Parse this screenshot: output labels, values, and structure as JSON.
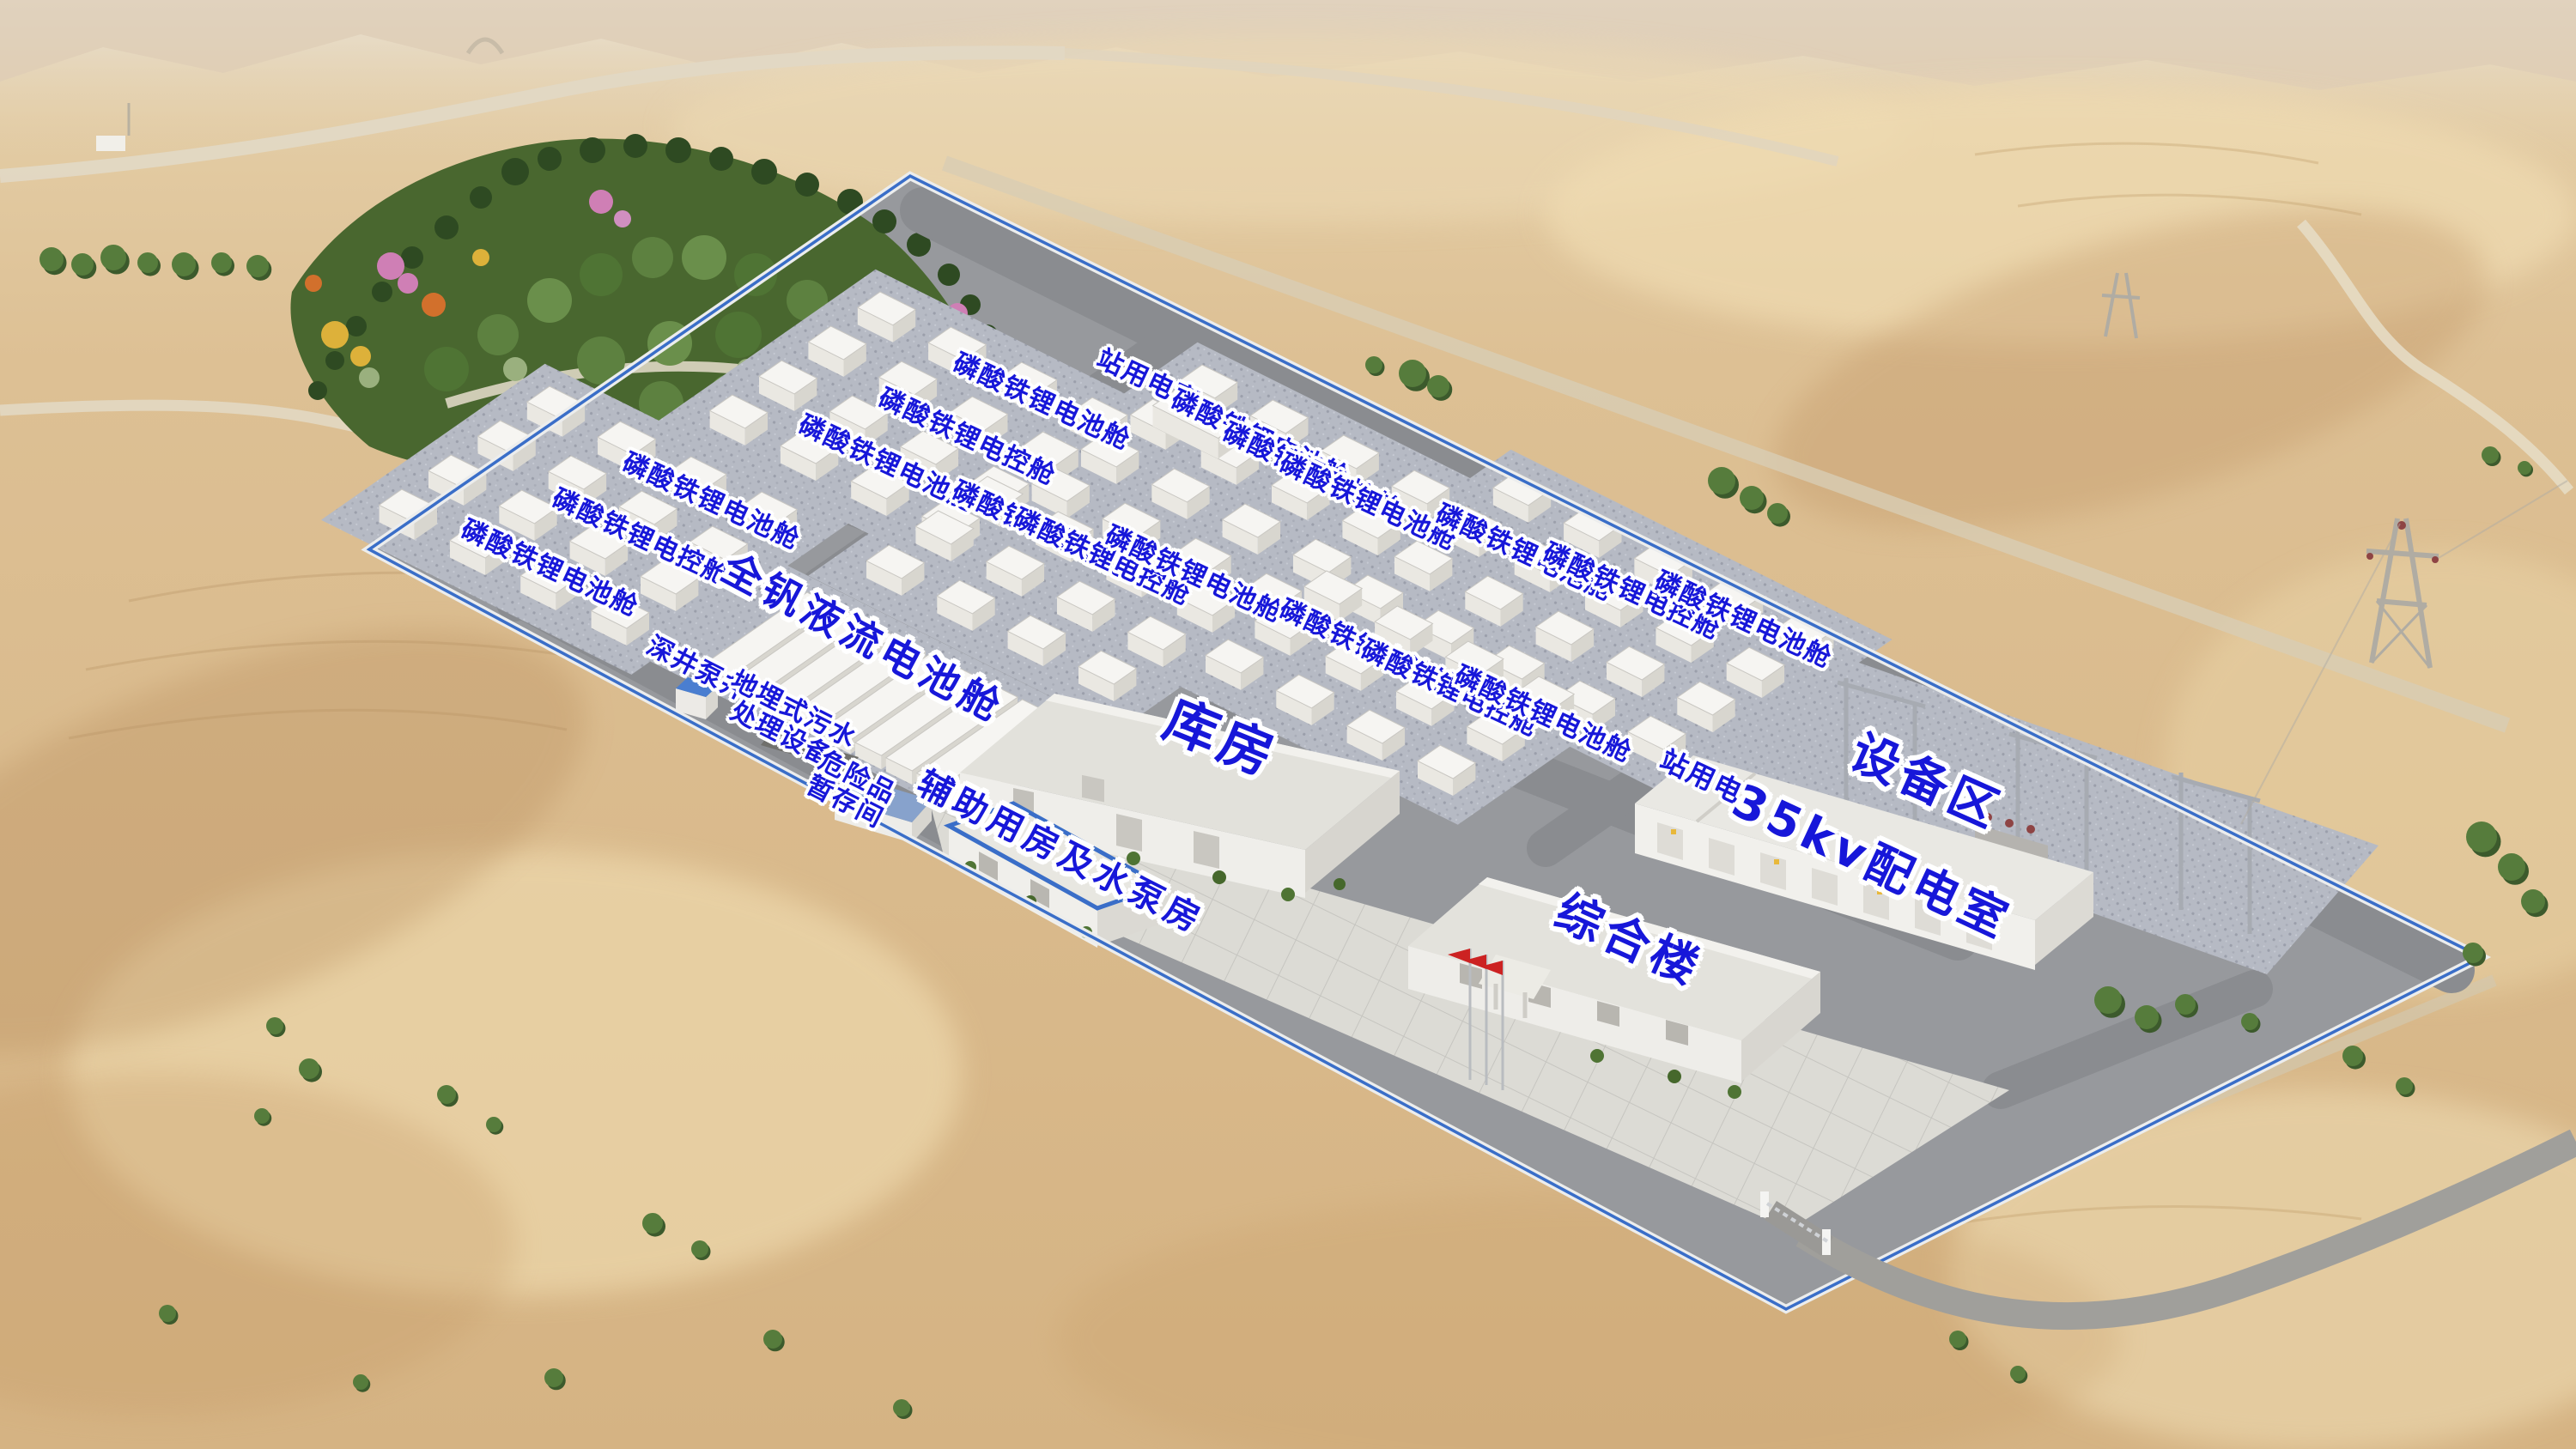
{
  "labels": {
    "battery_cabin": "磷酸铁锂电池舱",
    "control_cabin": "磷酸铁锂电控舱",
    "station_power_room": "站用电室",
    "vanadium_flow_battery_cabin": "全钒液流电池舱",
    "deep_well_pump": "深井泵井",
    "sewage_treatment_line1": "地埋式污水",
    "sewage_treatment_line2": "处理设备",
    "hazmat_storage_line1": "危险品",
    "hazmat_storage_line2": "暂存间",
    "warehouse": "库房",
    "complex_building": "综合楼",
    "equipment_area": "设备区",
    "distribution_room_35kv": "35kv配电室",
    "auxiliary_rooms_pump_house": "辅助用房及水泵房"
  },
  "colors": {
    "label_text": "#1717d9",
    "label_outline": "#ffffff",
    "wall_trim": "#3a6ec8",
    "desert_sand": "#dcbd8e",
    "site_road": "#8d8f93",
    "cabin_pad": "#b5b9c3",
    "plaza_tile": "#dcdbd5",
    "garden_green": "#4f7434",
    "flag_red": "#cc2222"
  }
}
